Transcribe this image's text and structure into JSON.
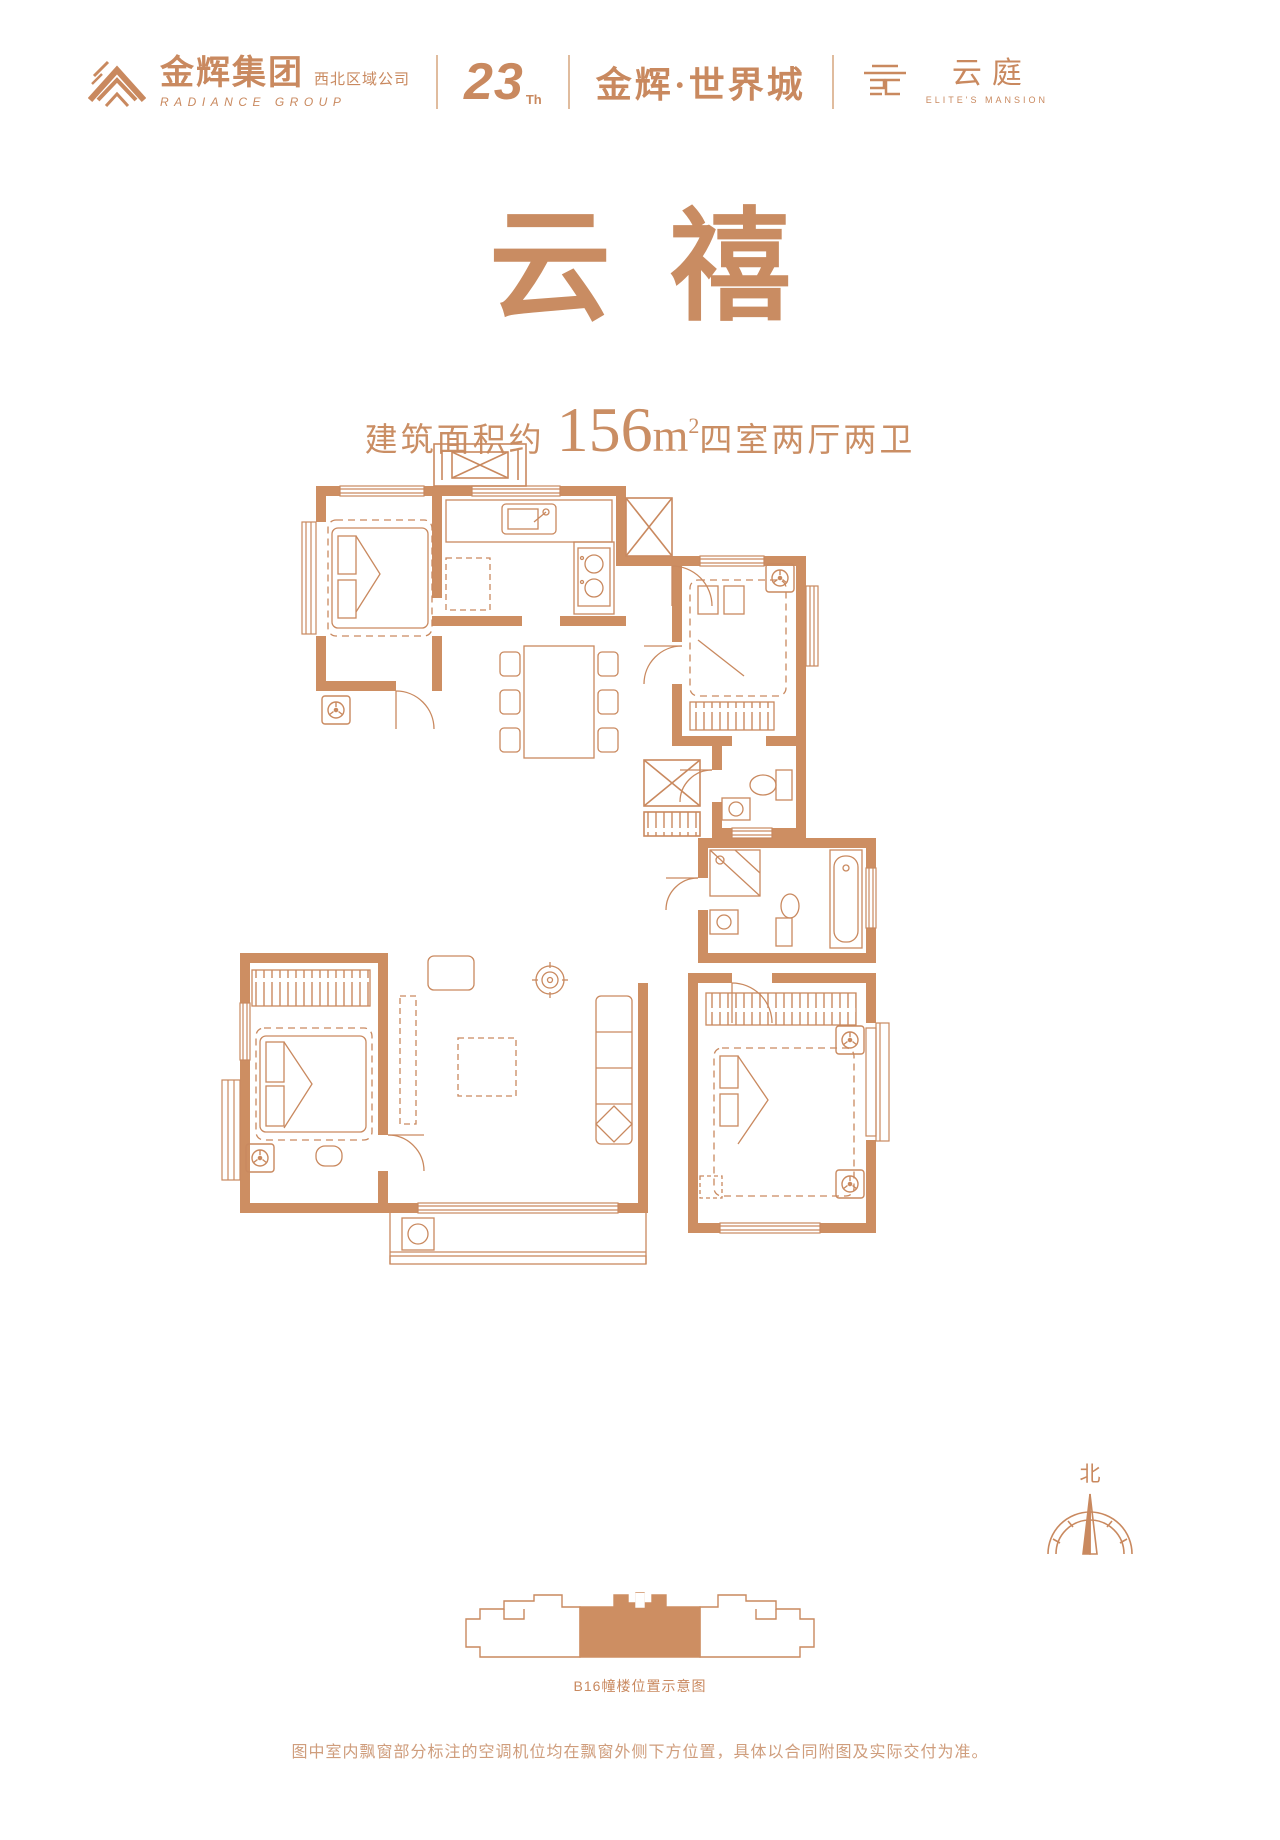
{
  "header": {
    "group_logo": {
      "cn": "金辉集团",
      "region": "西北区域公司",
      "en": "RADIANCE GROUP"
    },
    "anniversary": {
      "number": "23",
      "suffix": "Th"
    },
    "project_name": "金辉·世界城",
    "sub_brand": {
      "cn": "云庭",
      "en": "ELITE'S MANSION"
    }
  },
  "hero": {
    "unit_char_1": "云",
    "unit_char_2": "禧",
    "area_prefix": "建筑面积约",
    "area_value": "156",
    "area_unit": "m",
    "area_exponent": "2",
    "layout_desc": "四室两厅两卫"
  },
  "floorplan": {
    "compass_label": "北",
    "icons": {
      "ac_unit": "fan-in-box",
      "shaft": "crossed-box",
      "window": "triple-line-band",
      "wardrobe": "hanger-strip"
    }
  },
  "locator": {
    "caption": "B16幢楼位置示意图"
  },
  "footer": {
    "disclaimer": "图中室内飘窗部分标注的空调机位均在飘窗外侧下方位置，具体以合同附图及实际交付为准。"
  },
  "colors": {
    "accent": "#c9895f",
    "wall_fill": "#cd8e62",
    "title": "#c98c62",
    "footer_text": "#cf9d7c"
  }
}
